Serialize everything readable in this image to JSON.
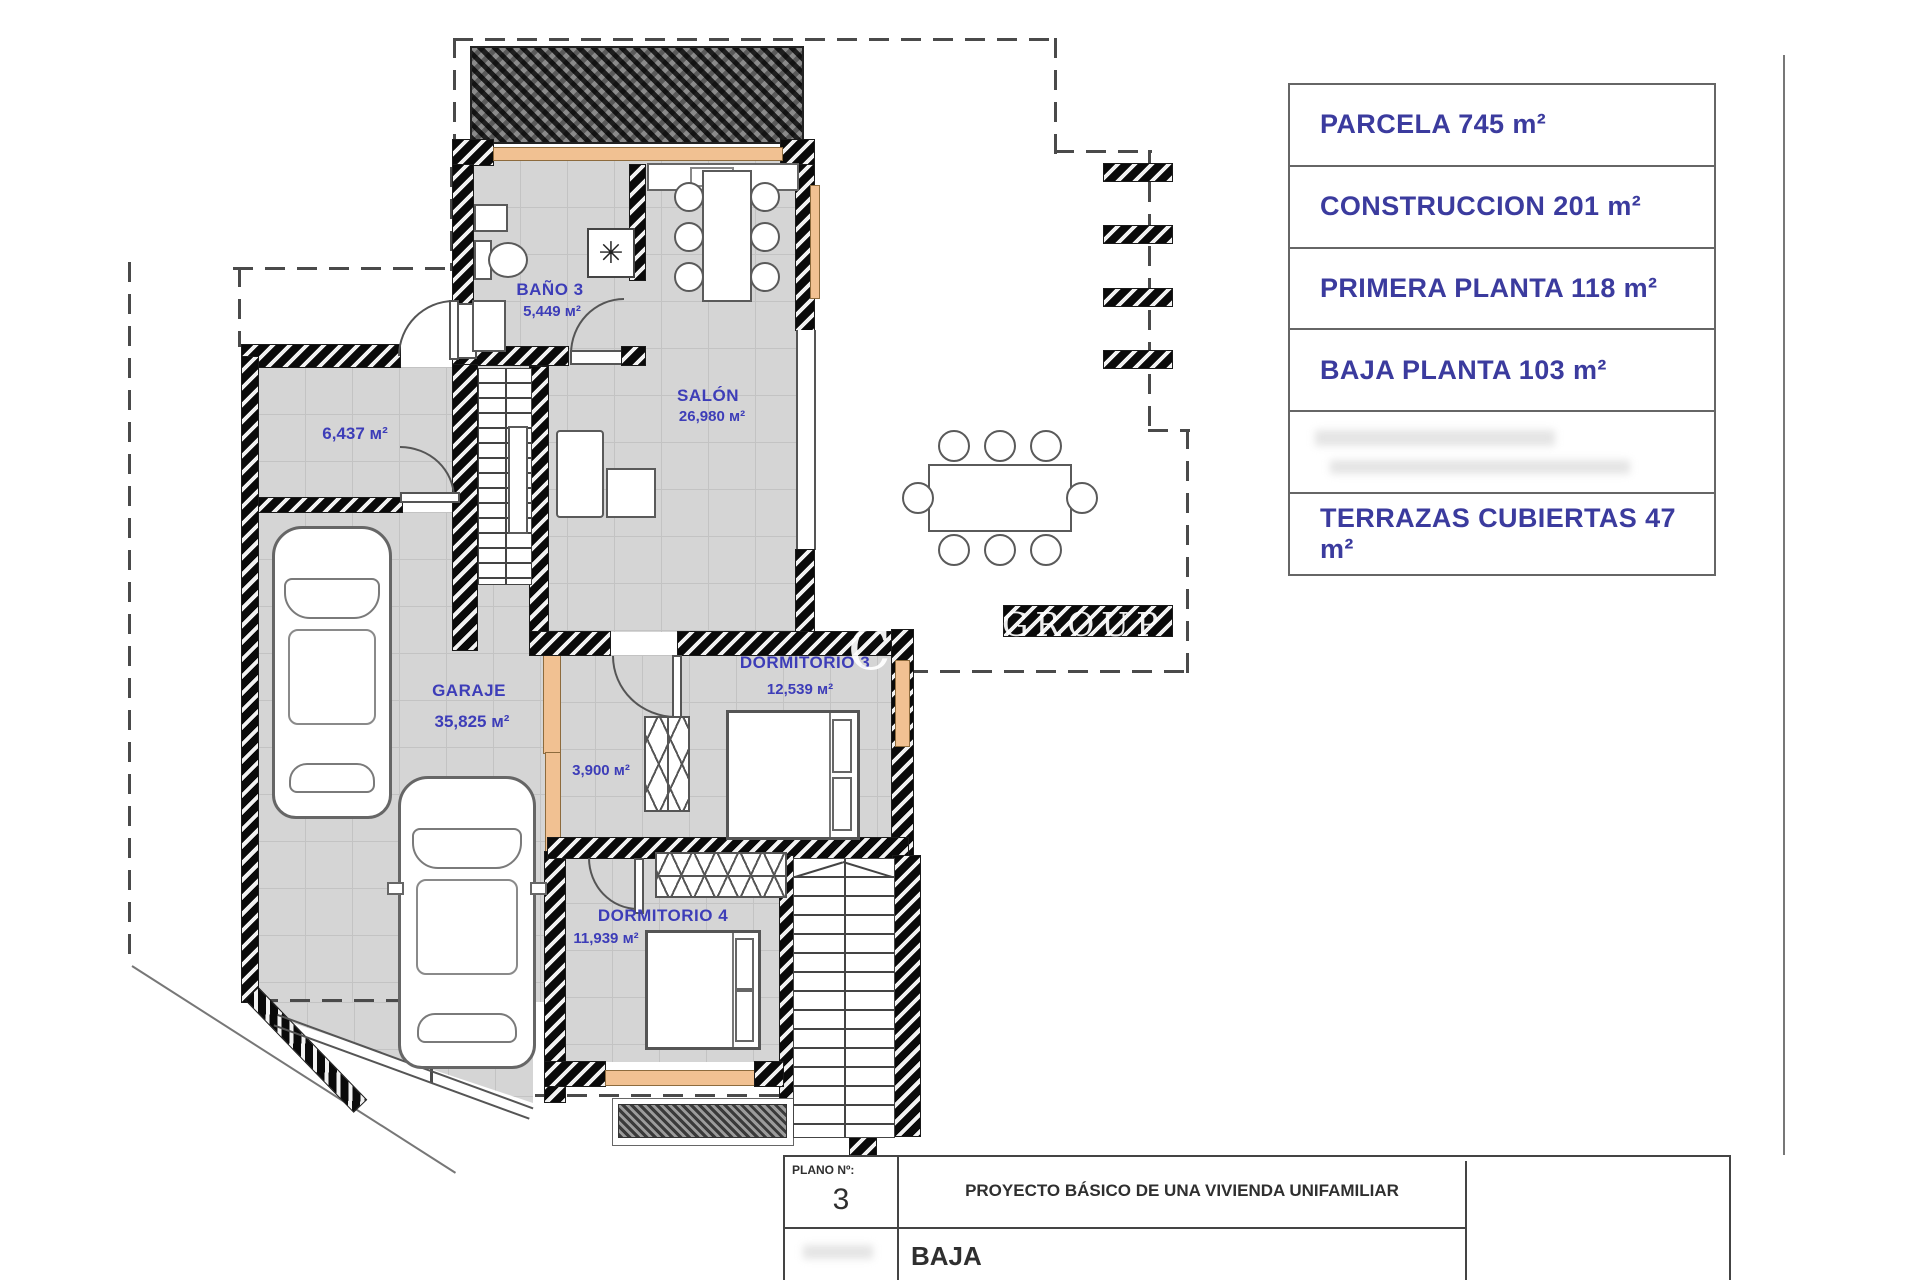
{
  "plan_title": "PLANTA BAJA",
  "rooms": {
    "bano3": {
      "name": "BAÑO 3",
      "area": "5,449 м²"
    },
    "salon": {
      "name": "SALÓN",
      "area": "26,980 м²"
    },
    "storage": {
      "area": "6,437 м²"
    },
    "garaje": {
      "name": "GARAJE",
      "area": "35,825 м²"
    },
    "dorm3": {
      "name": "DORMITORIO 3",
      "area": "12,539 м²"
    },
    "hall": {
      "area": "3,900 м²"
    },
    "dorm4": {
      "name": "DORMITORIO 4",
      "area": "11,939 м²"
    }
  },
  "legend": {
    "rows": [
      "PARCELA 745 m²",
      "CONSTRUCCION 201 m²",
      "PRIMERA PLANTA 118 m²",
      "BAJA PLANTA 103 m²",
      "",
      "TERRAZAS CUBIERTAS 47 m²"
    ]
  },
  "title_block": {
    "plano_label": "PLANO Nº:",
    "plano_number": "3",
    "project_title": "PROYECTO BÁSICO DE UNA VIVIENDA UNIFAMILIAR",
    "floor_label": "BAJA"
  },
  "watermark": {
    "letters": "C O",
    "group": "GROUP"
  },
  "symbols": {
    "fan": "✳"
  },
  "colors": {
    "label_blue": "#3d3db8",
    "window_orange": "#f1c192",
    "wall_black": "#0a0a0a"
  }
}
